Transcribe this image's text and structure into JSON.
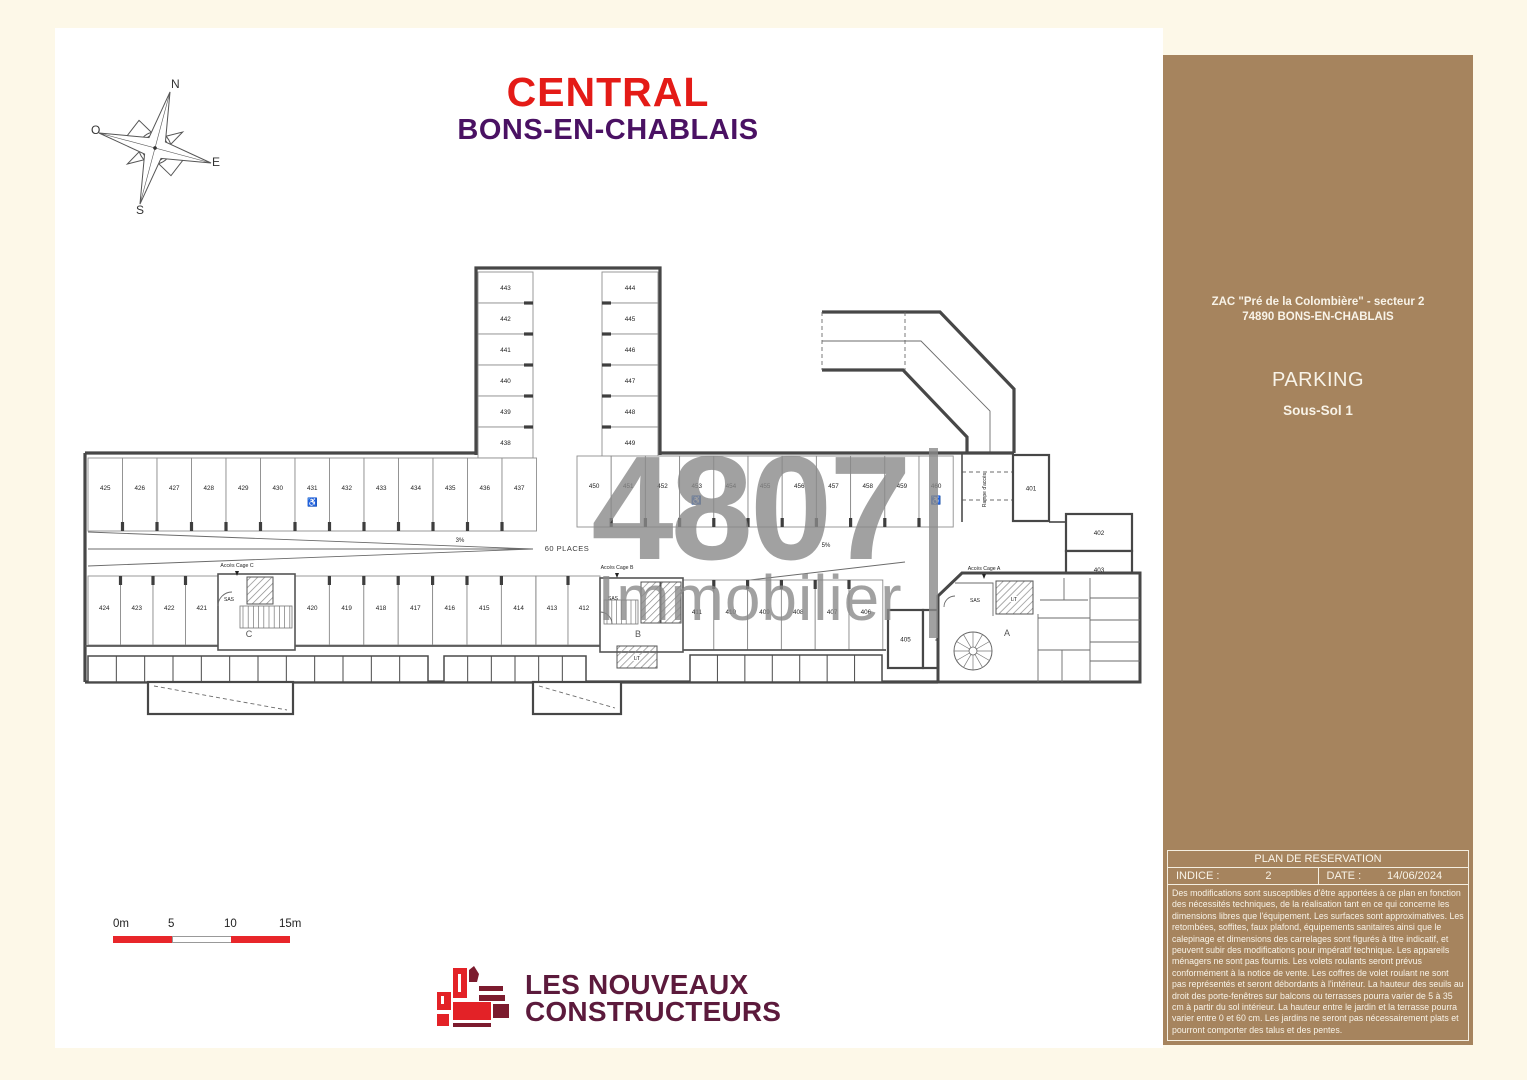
{
  "header": {
    "title": "CENTRAL",
    "subtitle": "BONS-EN-CHABLAIS"
  },
  "compass": {
    "n": "N",
    "s": "S",
    "e": "E",
    "o": "O"
  },
  "watermark": {
    "line1": "4807",
    "line2": "Immobilier"
  },
  "scalebar": {
    "labels": [
      "0m",
      "5",
      "10",
      "15m"
    ],
    "red": "#e8262a"
  },
  "footer_logo": {
    "line1": "LES NOUVEAUX",
    "line2": "CONSTRUCTEURS"
  },
  "sidebar": {
    "address_line1": "ZAC \"Pré de la Colombière\" - secteur 2",
    "address_line2": "74890 BONS-EN-CHABLAIS",
    "level_title": "PARKING",
    "level_subtitle": "Sous-Sol 1",
    "table": {
      "header": "PLAN DE RESERVATION",
      "indice_label": "INDICE :",
      "indice_value": "2",
      "date_label": "DATE :",
      "date_value": "14/06/2024"
    },
    "disclaimer": "Des modifications sont susceptibles d'être apportées à ce plan en fonction des nécessités techniques, de la réalisation tant en ce qui concerne les dimensions libres que l'équipement. Les surfaces sont approximatives. Les retombées, soffites, faux plafond, équipements sanitaires ainsi que le calepinage et dimensions des carrelages sont figurés à titre indicatif, et peuvent subir des modifications pour impératif technique. Les appareils ménagers ne sont pas fournis.  Les volets roulants seront prévus conformément à la notice de vente. Les coffres de volet roulant ne sont pas représentés et seront débordants à l'intérieur. La hauteur des seuils au droit des porte-fenêtres sur balcons ou terrasses pourra varier de 5 à 35 cm à partir du sol intérieur. La hauteur entre le jardin et la terrasse pourra varier entre 0 et 60 cm. Les jardins ne seront pas nécessairement plats et pourront comporter des talus et des pentes."
  },
  "plan": {
    "labels": {
      "places": "60 PLACES",
      "slope_west": "3%",
      "slope_east": "5%",
      "ramp": "Rampe d'accès",
      "access_a": "Accès Cage A",
      "access_b": "Accès Cage B",
      "access_c": "Accès Cage C",
      "sas": "SAS",
      "lt": "LT",
      "stair_a": "A",
      "stair_b": "B",
      "stair_c": "C"
    },
    "stall_groups": [
      {
        "id": "block-left",
        "numbers": [
          "443",
          "442",
          "441",
          "440",
          "439",
          "438"
        ]
      },
      {
        "id": "block-right",
        "numbers": [
          "444",
          "445",
          "446",
          "447",
          "448",
          "449"
        ]
      },
      {
        "id": "west-top",
        "numbers": [
          "425",
          "426",
          "427",
          "428",
          "429",
          "430",
          "431",
          "432",
          "433",
          "434",
          "435",
          "436",
          "437"
        ],
        "accessible": [
          "431"
        ]
      },
      {
        "id": "west-bottom-a",
        "numbers": [
          "424",
          "423",
          "422",
          "421"
        ]
      },
      {
        "id": "west-bottom-b",
        "numbers": [
          "420",
          "419",
          "418",
          "417",
          "416",
          "415",
          "414"
        ]
      },
      {
        "id": "west-bottom-c",
        "numbers": [
          "413",
          "412"
        ]
      },
      {
        "id": "east-top",
        "numbers": [
          "450",
          "451",
          "452",
          "453",
          "454",
          "455",
          "456",
          "457",
          "458",
          "459",
          "460"
        ],
        "accessible": [
          "453",
          "460"
        ]
      },
      {
        "id": "east-bottom",
        "numbers": [
          "411",
          "410",
          "409",
          "408",
          "407",
          "406"
        ]
      }
    ],
    "rooms": [
      {
        "id": "room-401",
        "label": "401"
      },
      {
        "id": "room-402",
        "label": "402"
      },
      {
        "id": "room-403",
        "label": "403"
      },
      {
        "id": "room-405",
        "label": "405"
      },
      {
        "id": "room-404",
        "label": "404"
      }
    ]
  }
}
